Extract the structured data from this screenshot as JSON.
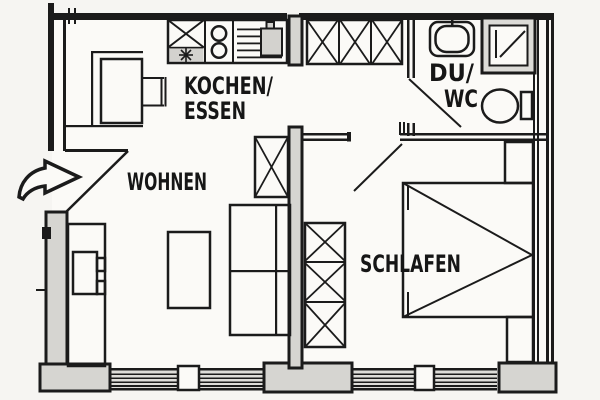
{
  "document": {
    "type": "architectural-floor-plan"
  },
  "colors": {
    "ink": "#1b1b1b",
    "paper": "#f6f5f2",
    "room_fill": "#fbfaf7",
    "wall_fill": "#d6d5d1",
    "shade_fill": "#d3d2ce"
  },
  "rooms": {
    "kitchen_dining": {
      "label_line1": "KOCHEN/",
      "label_line2": "ESSEN"
    },
    "living": {
      "label": "WOHNEN"
    },
    "bathroom": {
      "label_line1": "DU/",
      "label_line2": "WC"
    },
    "bedroom": {
      "label": "SCHLAFEN"
    }
  },
  "fixtures": {
    "entrance": "entrance-arrow-icon",
    "kitchen_counter": [
      "sink-x-unit",
      "two-burner-hob",
      "worktop-appliance"
    ],
    "dining": [
      "corner-bench",
      "dining-table",
      "chair"
    ],
    "living": [
      "tv-sideboard",
      "coffee-table",
      "sofa",
      "crossed-cabinet"
    ],
    "hall": [
      "wardrobe-three-sections"
    ],
    "bathroom": [
      "washbasin",
      "shower",
      "toilet-with-cistern"
    ],
    "bedroom": [
      "wardrobe-three-sections",
      "double-bed",
      "nightstand-top",
      "nightstand-bottom"
    ]
  }
}
